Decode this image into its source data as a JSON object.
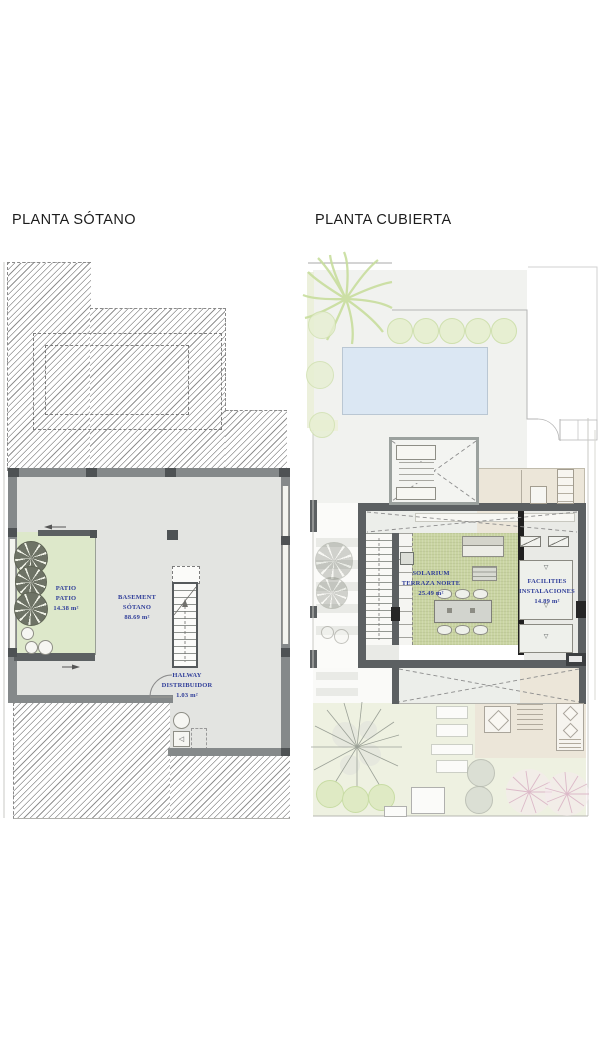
{
  "document": {
    "type": "architectural floor plan sheet",
    "background": "#ffffff"
  },
  "sotano": {
    "title": "PLANTA SÓTANO",
    "rooms": {
      "patio": {
        "line1": "PATIO",
        "line2": "PATIO",
        "area": "14.38 m²"
      },
      "basement": {
        "line1": "BASEMENT",
        "line2": "SÓTANO",
        "area": "88.69 m²"
      },
      "hallway": {
        "line1": "HALWAY",
        "line2": "DISTRIBUIDOR",
        "area": "1.03 m²"
      }
    }
  },
  "cubierta": {
    "title": "PLANTA CUBIERTA",
    "rooms": {
      "solarium": {
        "line1": "SOLARIUM",
        "line2": "TERRAZA NORTE",
        "area": "25.49 m²"
      },
      "facilities": {
        "line1": "FACILITIES",
        "line2": "INSTALACIONES",
        "area": "14.89 m²"
      }
    }
  },
  "colors": {
    "label_blue": "#2f3d99",
    "wall_gray": "#85898a",
    "wall_dark": "#5c6062",
    "patio_green": "#dde8ca",
    "solarium_green": "#c9d4a2",
    "pool_blue": "#dbe7f3",
    "beige": "#ece6d9",
    "floor_gray": "#e3e4e1"
  }
}
